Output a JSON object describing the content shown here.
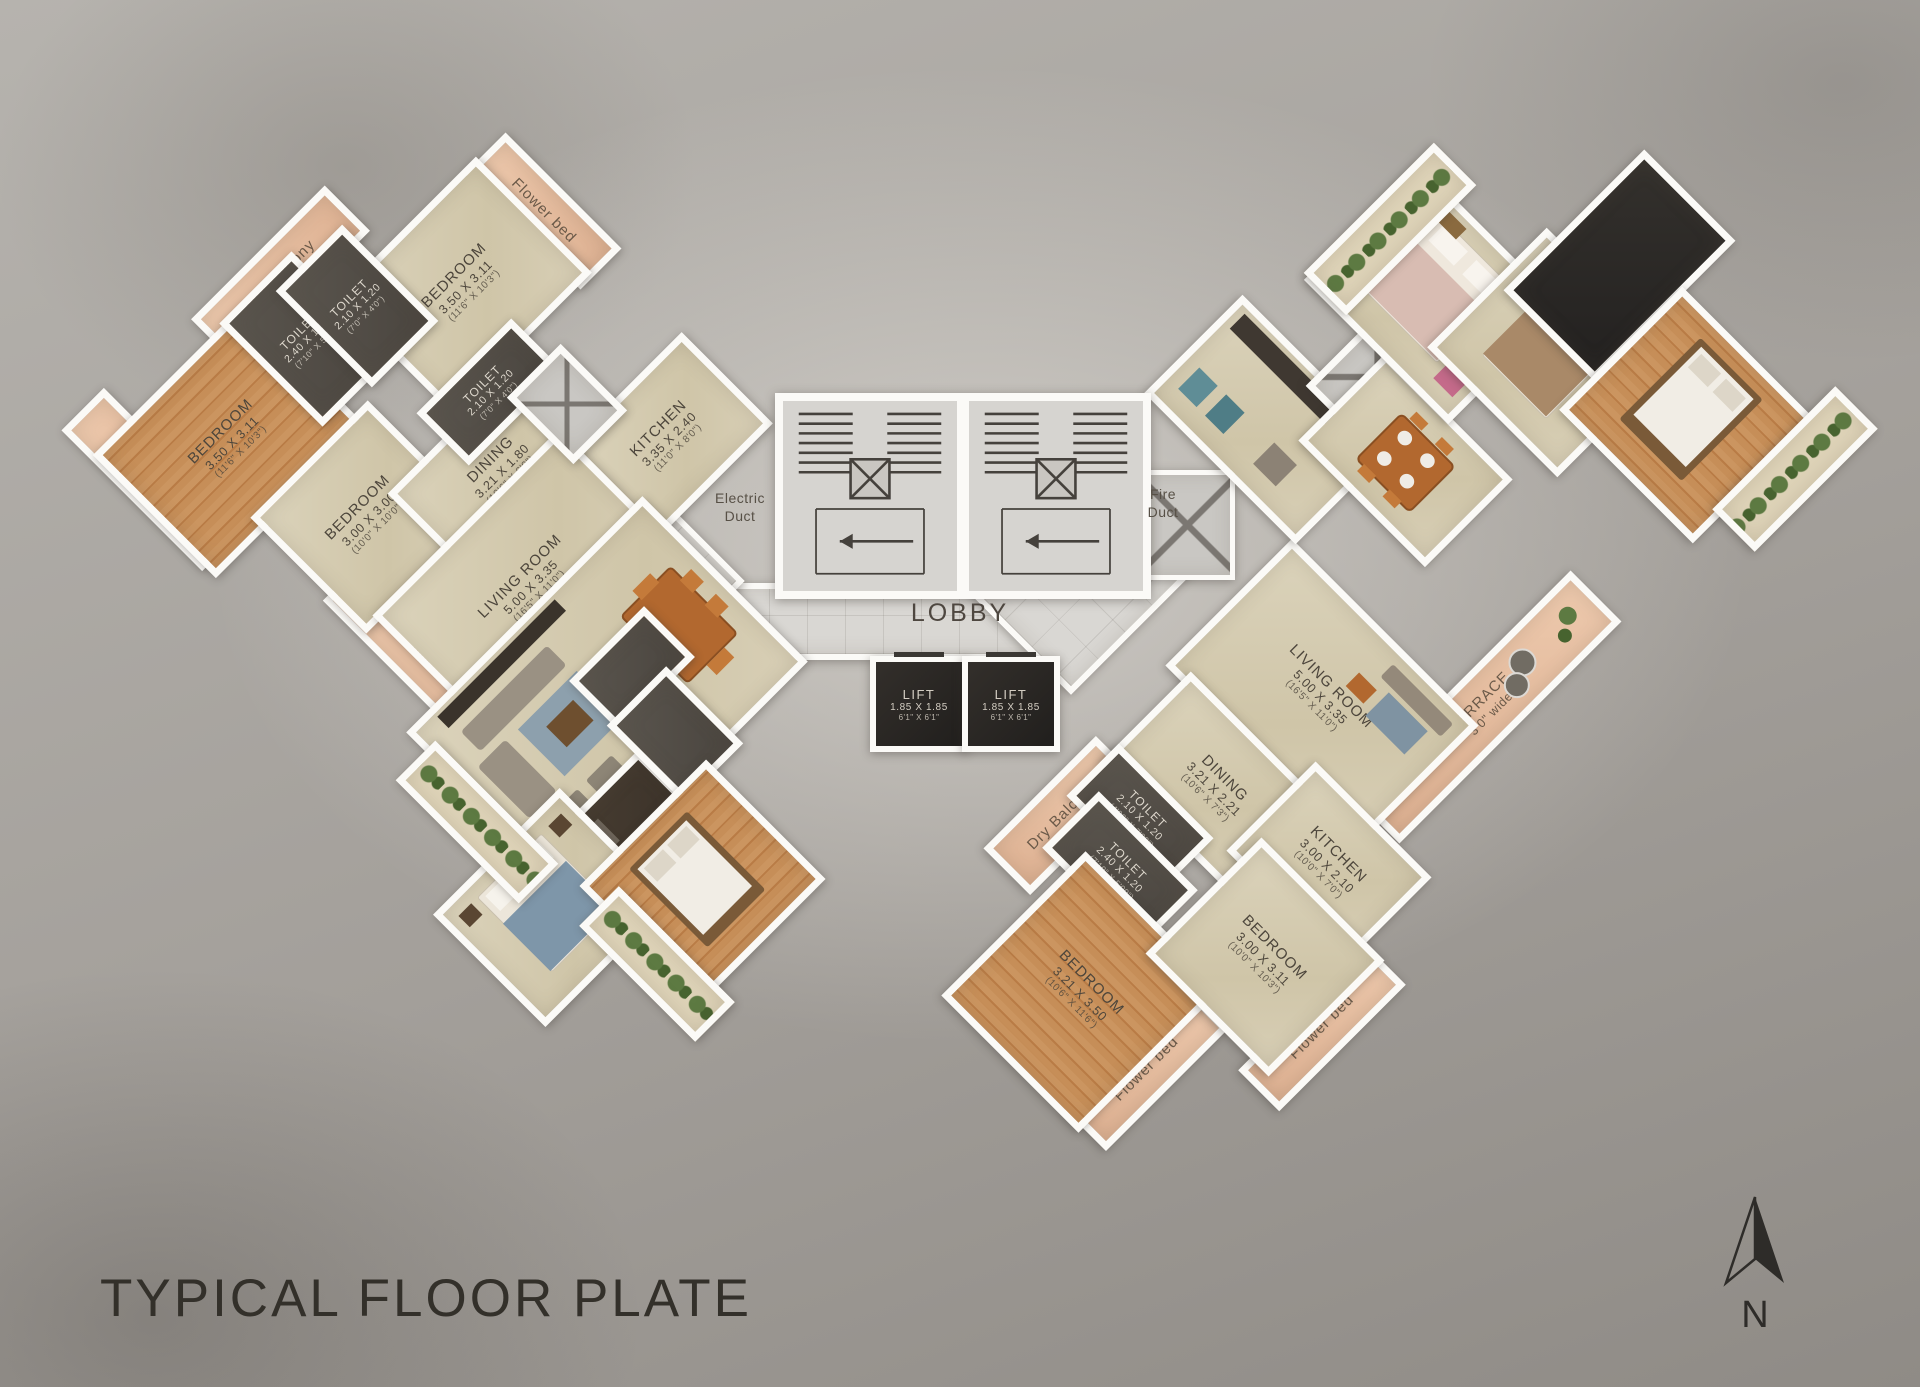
{
  "title": "TYPICAL FLOOR PLATE",
  "north_label": "N",
  "colors": {
    "background": "#a7a39d",
    "wall": "#fbfaf7",
    "beige_floor": "#d6cdb2",
    "wood_floor": "#c18a54",
    "dark_room": "#544f49",
    "peach_strip": "#e7c0a4",
    "lobby_tile": "#dbd9d5",
    "plant_green": "#55713c",
    "ink": "#4c453b"
  },
  "core": {
    "lobby_label": "LOBBY",
    "electric_duct_label": "Electric\nDuct",
    "fire_duct_label": "Fire\nDuct"
  },
  "lifts": [
    {
      "name": "LIFT",
      "dim": "1.85 X 1.85",
      "ft": "6'1\" X 6'1\""
    },
    {
      "name": "LIFT",
      "dim": "1.85 X 1.85",
      "ft": "6'1\" X 6'1\""
    }
  ],
  "rooms": [
    {
      "id": "flower-bed-left",
      "wing": "left",
      "rot": -45,
      "type": "peach",
      "v": true,
      "cx": 146,
      "cy": 472,
      "w": 46,
      "h": 185,
      "name": "Flower bed"
    },
    {
      "id": "dry-balcony-left",
      "wing": "left",
      "rot": -45,
      "type": "peach",
      "cx": 273,
      "cy": 268,
      "w": 175,
      "h": 50,
      "name": "Dry Balcony"
    },
    {
      "id": "flower-bed-left-top",
      "wing": "left",
      "rot": -45,
      "type": "peach",
      "v": true,
      "cx": 536,
      "cy": 204,
      "w": 44,
      "h": 150,
      "name": "Flower bed"
    },
    {
      "id": "terrace-left",
      "wing": "left",
      "rot": -45,
      "type": "peach",
      "v": true,
      "cx": 430,
      "cy": 655,
      "w": 60,
      "h": 235,
      "name": "TERRACE",
      "dim": "3'0\" wide"
    },
    {
      "id": "bedroom-left-wood",
      "wing": "left",
      "rot": -45,
      "type": "wood",
      "cx": 223,
      "cy": 434,
      "w": 200,
      "h": 160,
      "name": "BEDROOM",
      "dim": "3.50 X 3.11",
      "ft": "(11'6\" X 10'3\")"
    },
    {
      "id": "bedroom-left-2",
      "wing": "left",
      "rot": -45,
      "type": "beige",
      "cx": 456,
      "cy": 278,
      "w": 185,
      "h": 150,
      "name": "BEDROOM",
      "dim": "3.50 X 3.11",
      "ft": "(11'6\" X 10'3\")"
    },
    {
      "id": "bedroom-left-3",
      "wing": "left",
      "rot": -45,
      "type": "beige",
      "cx": 360,
      "cy": 510,
      "w": 152,
      "h": 150,
      "name": "BEDROOM",
      "dim": "3.00 X 3.00",
      "ft": "(10'0\" X 10'0\")"
    },
    {
      "id": "dining-left",
      "wing": "left",
      "rot": -45,
      "type": "beige",
      "cx": 493,
      "cy": 462,
      "w": 180,
      "h": 110,
      "name": "DINING",
      "dim": "3.21 X 1.80",
      "ft": "(10'6\" X 6'0\")"
    },
    {
      "id": "kitchen-left",
      "wing": "left",
      "rot": -45,
      "type": "beige",
      "cx": 660,
      "cy": 430,
      "w": 155,
      "h": 115,
      "name": "KITCHEN",
      "dim": "3.35 X 2.40",
      "ft": "(11'0\" X 8'0\")"
    },
    {
      "id": "living-room-left",
      "wing": "left",
      "rot": -45,
      "type": "beige",
      "cx": 522,
      "cy": 578,
      "w": 250,
      "h": 165,
      "name": "LIVING ROOM",
      "dim": "5.00 X 3.35",
      "ft": "(16'5\" X 11'0\")"
    },
    {
      "id": "toilet-left-1",
      "wing": "left",
      "rot": -45,
      "type": "dark",
      "small": true,
      "cx": 300,
      "cy": 332,
      "w": 88,
      "h": 132,
      "name": "TOILET",
      "dim": "2.40 X 1.50",
      "ft": "(7'10\" X 5'0\")"
    },
    {
      "id": "toilet-left-2",
      "wing": "left",
      "rot": -45,
      "type": "dark",
      "small": true,
      "cx": 350,
      "cy": 299,
      "w": 80,
      "h": 122,
      "name": "TOILET",
      "dim": "2.10 X 1.20",
      "ft": "(7'0\" X 4'0\")"
    },
    {
      "id": "toilet-left-3",
      "wing": "left",
      "rot": -45,
      "type": "dark",
      "small": true,
      "cx": 483,
      "cy": 385,
      "w": 120,
      "h": 60,
      "name": "TOILET",
      "dim": "2.10 X 1.20",
      "ft": "(7'0\" X 4'0\")"
    },
    {
      "id": "duct-left",
      "wing": "left",
      "rot": -45,
      "type": "gray xbox",
      "cx": 560,
      "cy": 397,
      "w": 62,
      "h": 80
    },
    {
      "id": "furnished-living-left",
      "wing": "left",
      "rot": -45,
      "type": "beige",
      "cx": 600,
      "cy": 690,
      "w": 320,
      "h": 220,
      "deco": "living"
    },
    {
      "id": "furnished-kitchen-left",
      "wing": "left",
      "rot": -45,
      "type": "counter",
      "cx": 583,
      "cy": 843,
      "w": 195,
      "h": 60,
      "deco": "kitchen"
    },
    {
      "id": "furnished-toilet-left-1",
      "wing": "left",
      "rot": -45,
      "type": "dark",
      "cx": 625,
      "cy": 662,
      "w": 92,
      "h": 58
    },
    {
      "id": "furnished-toilet-left-2",
      "wing": "left",
      "rot": -45,
      "type": "dark",
      "cx": 668,
      "cy": 727,
      "w": 70,
      "h": 95
    },
    {
      "id": "furnished-bedroom-left-blue",
      "wing": "left",
      "rot": -45,
      "type": "beige",
      "cx": 545,
      "cy": 900,
      "w": 165,
      "h": 145,
      "deco": "bed-blue"
    },
    {
      "id": "furnished-bedroom-left-wood",
      "wing": "left",
      "rot": -45,
      "type": "wood",
      "cx": 695,
      "cy": 875,
      "w": 165,
      "h": 155,
      "deco": "bed-white"
    },
    {
      "id": "flower-strip-left-1",
      "wing": "left",
      "rot": -45,
      "type": "green",
      "cx": 470,
      "cy": 815,
      "w": 42,
      "h": 160
    },
    {
      "id": "flower-strip-left-2",
      "wing": "left",
      "rot": -45,
      "type": "green",
      "cx": 650,
      "cy": 957,
      "w": 42,
      "h": 150
    },
    {
      "id": "dry-balcony-right",
      "wing": "right",
      "rot": 45,
      "type": "peach",
      "v": true,
      "cx": 1056,
      "cy": 808,
      "w": 52,
      "h": 145,
      "name": "Dry Balcony"
    },
    {
      "id": "terrace-right",
      "wing": "right",
      "rot": 45,
      "type": "peach",
      "v": true,
      "cx": 1478,
      "cy": 700,
      "w": 58,
      "h": 300,
      "name": "TERRACE",
      "dim": "3'0\" wide",
      "deco": "terrace-tables"
    },
    {
      "id": "flower-bed-right-1",
      "wing": "right",
      "rot": 45,
      "type": "peach",
      "v": true,
      "cx": 1140,
      "cy": 1062,
      "w": 44,
      "h": 160,
      "name": "Flower bed"
    },
    {
      "id": "flower-bed-right-2",
      "wing": "right",
      "rot": 45,
      "type": "peach",
      "v": true,
      "cx": 1315,
      "cy": 1020,
      "w": 44,
      "h": 165,
      "name": "Flower bed"
    },
    {
      "id": "living-room-right",
      "wing": "right",
      "rot": 45,
      "type": "beige",
      "cx": 1315,
      "cy": 688,
      "w": 250,
      "h": 165,
      "name": "LIVING ROOM",
      "dim": "5.00 X 3.35",
      "ft": "(16'5\" X 11'0\")",
      "deco": "living-light"
    },
    {
      "id": "dining-right",
      "wing": "right",
      "rot": 45,
      "type": "beige",
      "cx": 1208,
      "cy": 780,
      "w": 185,
      "h": 115,
      "name": "DINING",
      "dim": "3.21 X 2.21",
      "ft": "(10'6\" X 7'3\")"
    },
    {
      "id": "kitchen-right",
      "wing": "right",
      "rot": 45,
      "type": "beige",
      "cx": 1322,
      "cy": 857,
      "w": 150,
      "h": 112,
      "name": "KITCHEN",
      "dim": "3.00 X 2.10",
      "ft": "(10'0\" X 7'0\")"
    },
    {
      "id": "toilet-right-1",
      "wing": "right",
      "rot": 45,
      "type": "dark",
      "small": true,
      "cx": 1133,
      "cy": 810,
      "w": 120,
      "h": 60,
      "name": "TOILET",
      "dim": "2.10 X 1.20",
      "ft": "(4'00\" X 7'00\")"
    },
    {
      "id": "toilet-right-2",
      "wing": "right",
      "rot": 45,
      "type": "dark",
      "small": true,
      "cx": 1113,
      "cy": 862,
      "w": 126,
      "h": 66,
      "name": "TOILET",
      "dim": "2.40 X 1.20",
      "ft": "(7'10\" X 5'00\")"
    },
    {
      "id": "bedroom-right-wood",
      "wing": "right",
      "rot": 45,
      "type": "wood",
      "cx": 1075,
      "cy": 985,
      "w": 180,
      "h": 190,
      "name": "BEDROOM",
      "dim": "3.21 X 3.50",
      "ft": "(10'6\" X 11'6\")"
    },
    {
      "id": "bedroom-right-2",
      "wing": "right",
      "rot": 45,
      "type": "beige",
      "cx": 1258,
      "cy": 950,
      "w": 160,
      "h": 150,
      "name": "BEDROOM",
      "dim": "3.00 X 3.11",
      "ft": "(10'0\" X 10'3\")"
    },
    {
      "id": "furnished-kitchen-right",
      "wing": "right",
      "rot": 45,
      "type": "beige",
      "cx": 1262,
      "cy": 412,
      "w": 200,
      "h": 125,
      "deco": "kitchen2"
    },
    {
      "id": "duct-right",
      "wing": "right",
      "rot": 45,
      "type": "gray xbox",
      "cx": 1370,
      "cy": 370,
      "w": 75,
      "h": 100
    },
    {
      "id": "furnished-dining-right",
      "wing": "right",
      "rot": 45,
      "type": "beige",
      "cx": 1398,
      "cy": 453,
      "w": 165,
      "h": 110,
      "deco": "dining2"
    },
    {
      "id": "furnished-bedroom-right-1",
      "wing": "right",
      "rot": 45,
      "type": "beige",
      "cx": 1427,
      "cy": 287,
      "w": 190,
      "h": 150,
      "deco": "bed-pink"
    },
    {
      "id": "flower-strip-right-1",
      "wing": "right",
      "rot": 45,
      "type": "green",
      "cx": 1383,
      "cy": 222,
      "w": 46,
      "h": 170
    },
    {
      "id": "furnished-bedroom-right-2",
      "wing": "right",
      "rot": 45,
      "type": "beige",
      "cx": 1545,
      "cy": 345,
      "w": 170,
      "h": 155,
      "deco": "bed-brown"
    },
    {
      "id": "dark-terrace-right",
      "wing": "right",
      "rot": 45,
      "type": "slab",
      "cx": 1612,
      "cy": 258,
      "w": 115,
      "h": 185
    },
    {
      "id": "furnished-bedroom-right-wood",
      "wing": "right",
      "rot": 45,
      "type": "wood",
      "cx": 1680,
      "cy": 408,
      "w": 175,
      "h": 160,
      "deco": "bed-white"
    },
    {
      "id": "flower-strip-right-2",
      "wing": "right",
      "rot": 45,
      "type": "green",
      "cx": 1788,
      "cy": 462,
      "w": 46,
      "h": 160
    }
  ]
}
